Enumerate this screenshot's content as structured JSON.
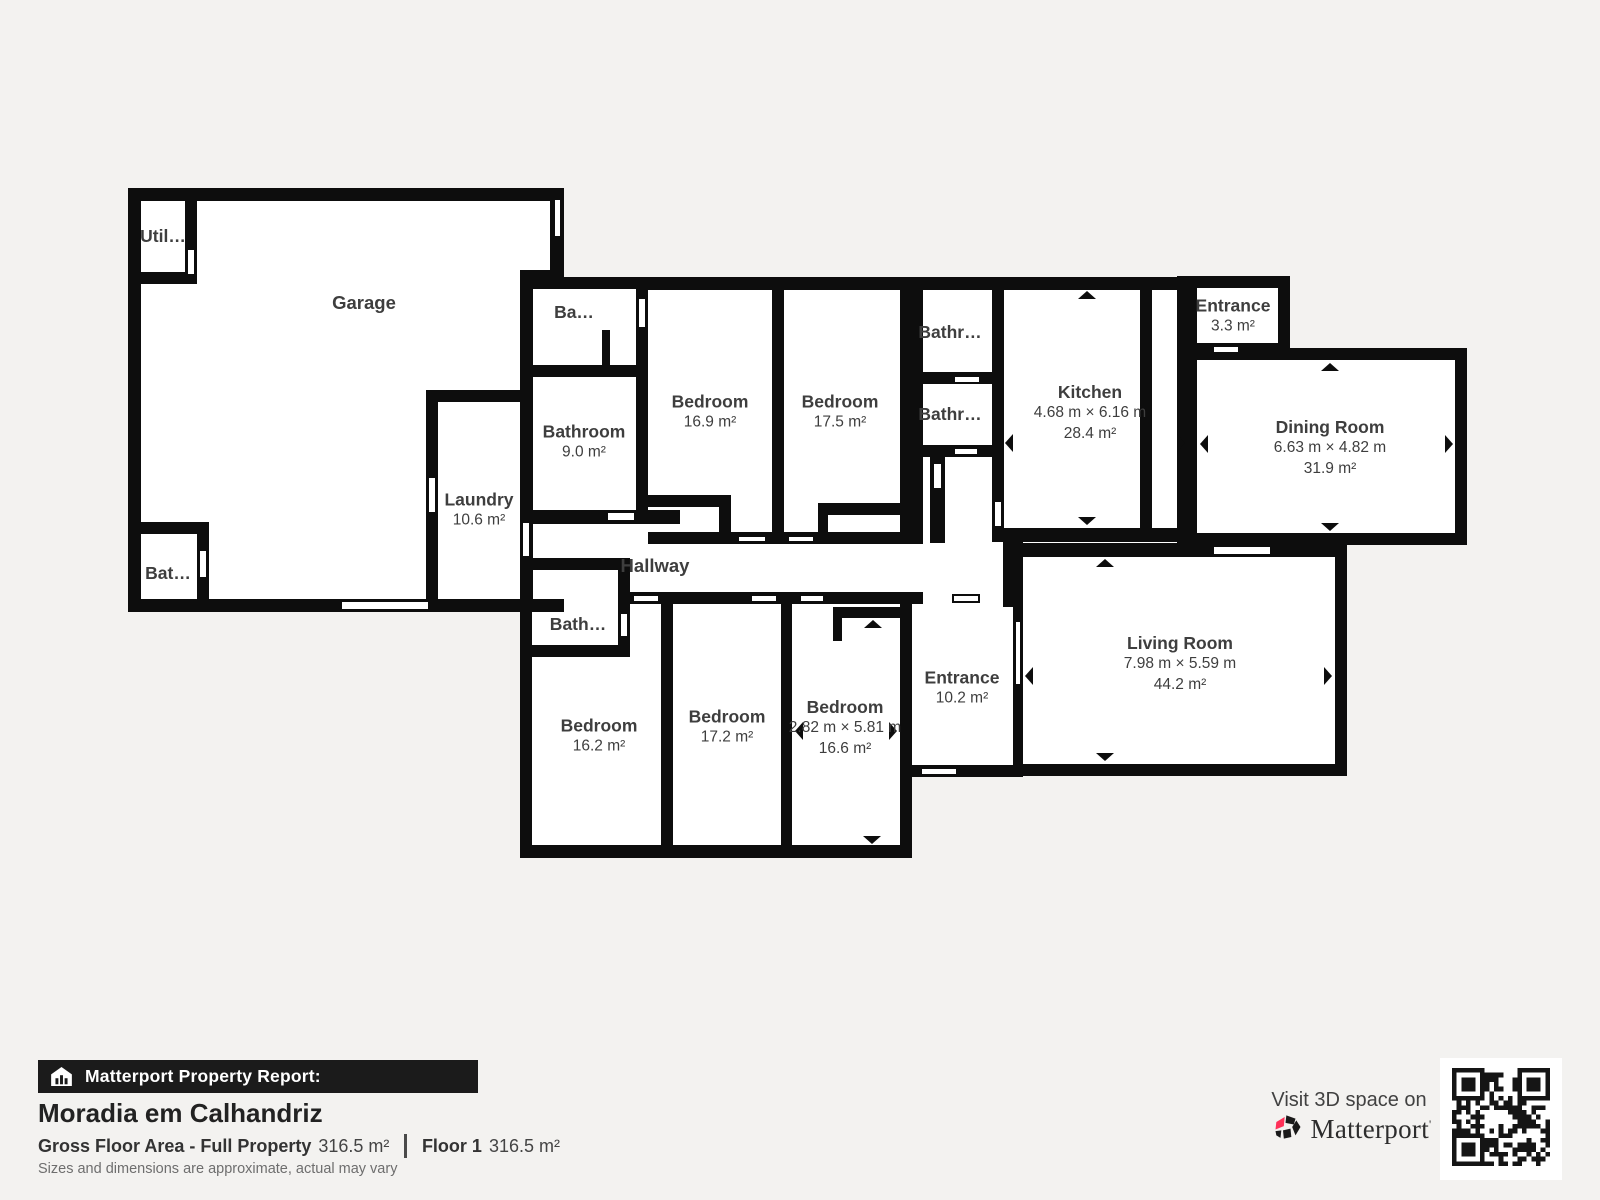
{
  "rooms": {
    "garage": {
      "name": "Garage"
    },
    "utility": {
      "name": "Util…"
    },
    "bathroom_garage": {
      "name": "Bat…"
    },
    "laundry": {
      "name": "Laundry",
      "area": "10.6 m²"
    },
    "bathroom_small_top": {
      "name": "Ba…"
    },
    "bathroom_9": {
      "name": "Bathroom",
      "area": "9.0 m²"
    },
    "bedroom_169": {
      "name": "Bedroom",
      "area": "16.9 m²"
    },
    "bedroom_175": {
      "name": "Bedroom",
      "area": "17.5 m²"
    },
    "bathroom_top_1": {
      "name": "Bathr…"
    },
    "bathroom_top_2": {
      "name": "Bathr…"
    },
    "kitchen": {
      "name": "Kitchen",
      "dims": "4.68 m × 6.16 m",
      "area": "28.4 m²"
    },
    "entrance_33": {
      "name": "Entrance",
      "area": "3.3 m²"
    },
    "dining": {
      "name": "Dining Room",
      "dims": "6.63 m × 4.82 m",
      "area": "31.9 m²"
    },
    "hallway": {
      "name": "Hallway"
    },
    "bathroom_lower": {
      "name": "Bath…"
    },
    "bedroom_162": {
      "name": "Bedroom",
      "area": "16.2 m²"
    },
    "bedroom_172": {
      "name": "Bedroom",
      "area": "17.2 m²"
    },
    "bedroom_166": {
      "name": "Bedroom",
      "dims": "2.82 m × 5.81 m",
      "area": "16.6 m²"
    },
    "entrance_102": {
      "name": "Entrance",
      "area": "10.2 m²"
    },
    "living": {
      "name": "Living Room",
      "dims": "7.98 m × 5.59 m",
      "area": "44.2 m²"
    }
  },
  "footer": {
    "report_label": "Matterport Property Report:",
    "property_title": "Moradia em Calhandriz",
    "gfa_label": "Gross Floor Area - Full Property",
    "gfa_value": "316.5 m²",
    "floor_label": "Floor 1",
    "floor_value": "316.5 m²",
    "disclaimer": "Sizes and dimensions are approximate, actual may vary"
  },
  "cta": {
    "visit_text": "Visit 3D space on",
    "brand": "Matterport"
  },
  "colors": {
    "background": "#f3f2f0",
    "wall": "#0d0d0d",
    "label": "#3e3e3e",
    "brand_pink": "#ff3158"
  }
}
